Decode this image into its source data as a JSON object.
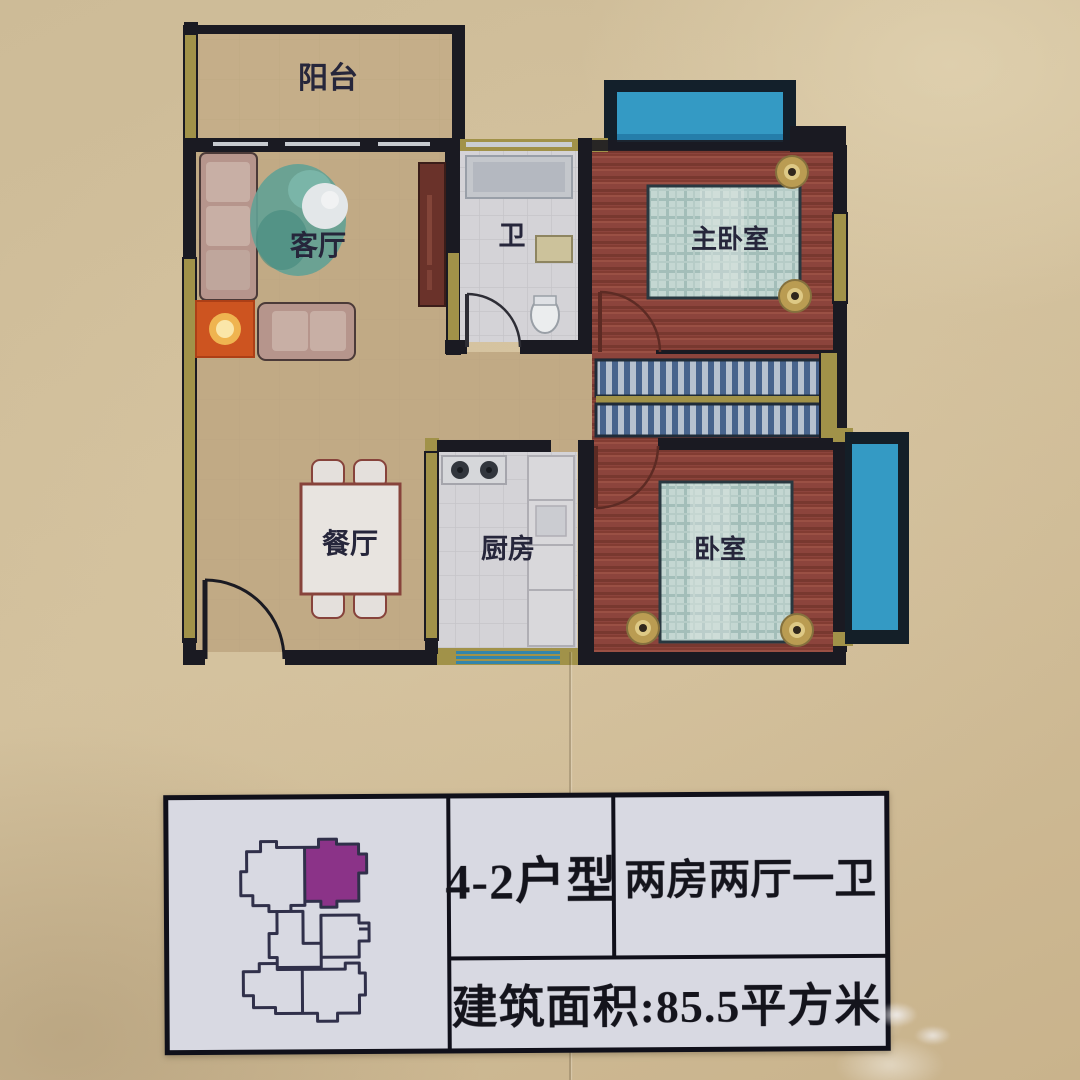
{
  "photo": {
    "description": "floor-plan display board photo",
    "background_color": "#cdbb97"
  },
  "floor_plan": {
    "rooms": [
      {
        "id": "balcony",
        "label": "阳台"
      },
      {
        "id": "living-room",
        "label": "客厅"
      },
      {
        "id": "bathroom",
        "label": "卫"
      },
      {
        "id": "master-bedroom",
        "label": "主卧室"
      },
      {
        "id": "dining-room",
        "label": "餐厅"
      },
      {
        "id": "kitchen",
        "label": "厨房"
      },
      {
        "id": "bedroom",
        "label": "卧室"
      }
    ],
    "colors": {
      "wall_dark": "#17171f",
      "wall_window_khaki": "#a39344",
      "wood_floor_red": "#8f4239",
      "floor_tan": "#c4ab84",
      "tile_gray": "#d7d6da",
      "window_blue": "#2e9cc9",
      "bed_plaid": "#c6dad4",
      "rug_orange": "#d4521a"
    }
  },
  "info_table": {
    "unit_type": "4-2户型",
    "layout": "两房两厅一卫",
    "area": "建筑面积:85.5平方米",
    "background": "#d8d9e2",
    "key_plan": {
      "highlighted_unit": "top-right",
      "highlight_color": "#8b3388"
    }
  }
}
